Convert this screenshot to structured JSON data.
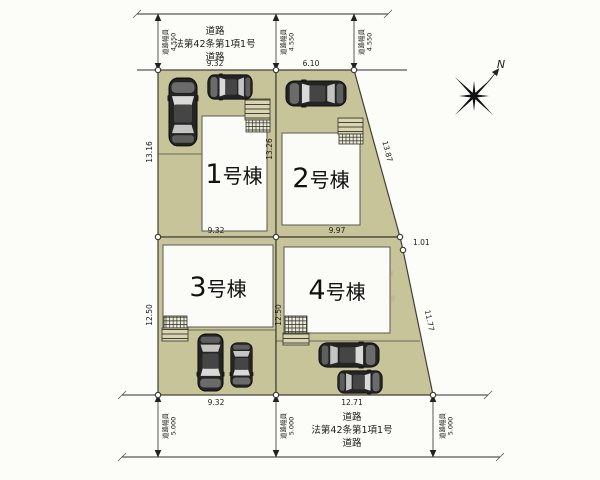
{
  "drawing": {
    "road_top": {
      "line1": "道路",
      "line2": "法第42条第1項1号",
      "line3": "道路",
      "width_label": "道路幅員",
      "width_value": "4.550"
    },
    "road_bottom": {
      "line1": "道路",
      "line2": "法第42条第1項1号",
      "line3": "道路",
      "width_label": "道路幅員",
      "width_value": "5.000"
    },
    "lots": [
      {
        "number": "1",
        "suffix": "号棟"
      },
      {
        "number": "2",
        "suffix": "号棟"
      },
      {
        "number": "3",
        "suffix": "号棟"
      },
      {
        "number": "4",
        "suffix": "号棟"
      }
    ],
    "dims": {
      "lot1_top": "9.32",
      "lot2_top": "6.10",
      "lot1_left": "13.16",
      "divider_1_2": "13.26",
      "lot2_slant": "13.87",
      "lot1_bottom": "9.32",
      "lot2_bottom": "9.97",
      "lot4_top_offset": "1.01",
      "lot3_left": "12.50",
      "divider_3_4": "12.50",
      "lot4_slant": "11.77",
      "lot3_bottom": "9.32",
      "lot4_bottom": "12.71"
    },
    "compass_label": "N",
    "watermark": "380",
    "colors": {
      "paper": "#fcfcf8",
      "lot_fill": "#c7c49a",
      "line_color": "#2e2e2e",
      "building_fill": "#fbfbf7"
    }
  }
}
